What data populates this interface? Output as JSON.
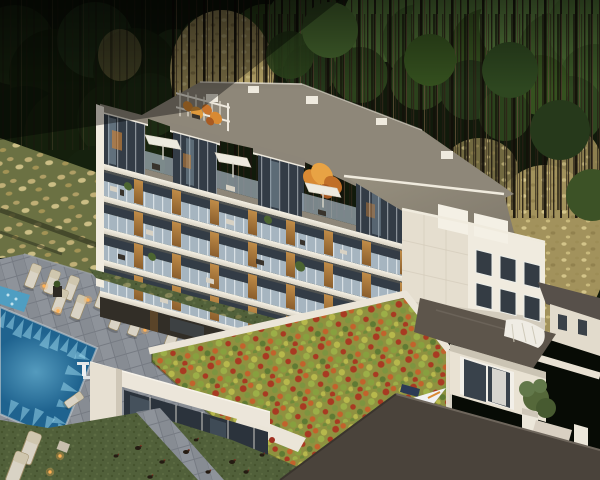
{
  "scene": {
    "alt": "Aerial dusk 3D rendering of a modern terraced apartment building nestled in a pine forest, with rooftop terraces, white umbrellas, a glowing swimming pool with sun loungers, a colorful red-and-green sedum roof over an amenity pavilion, lawns with hens, and white townhouses with dark gray roofs in the foreground",
    "time_of_day": "dusk",
    "setting": "pine forest hillside with ornamental grasses",
    "features": [
      "terraced apartment building with glass balconies and wood dividers",
      "rooftop pergola with autumn-orange planting",
      "roof terraces with white parasols",
      "swimming pool with spa and light caustics",
      "pool deck with rows of sun loungers and lit lanterns",
      "sedum green roof in red, orange and green",
      "glass amenity pavilion",
      "white townhouses with dark roofs",
      "lawn with hens",
      "small garden tree"
    ]
  },
  "colors": {
    "forest_dark": "#111a0b",
    "canopy_green": "#3f5c2e",
    "grass_tan": "#b3a166",
    "underbrush_olive": "#6b7143",
    "lawn_green": "#51603a",
    "deck_gray": "#878c93",
    "pool_deep": "#1f638f",
    "pool_light": "#9fdcf0",
    "spa_blue": "#4f9ec2",
    "facade_white": "#f0ebdf",
    "roof_gray": "#8e8779",
    "roof_dark": "#5d554b",
    "glass_dark": "#333c46",
    "railing_glass": "#a6b5c0",
    "wood_accent": "#b5813f",
    "sedum_olive": "#8f9140",
    "sedum_red": "#a83a22",
    "sedum_orange": "#c2622c",
    "umbrella_white": "#edeadf",
    "lantern_amber": "#ffb054"
  }
}
